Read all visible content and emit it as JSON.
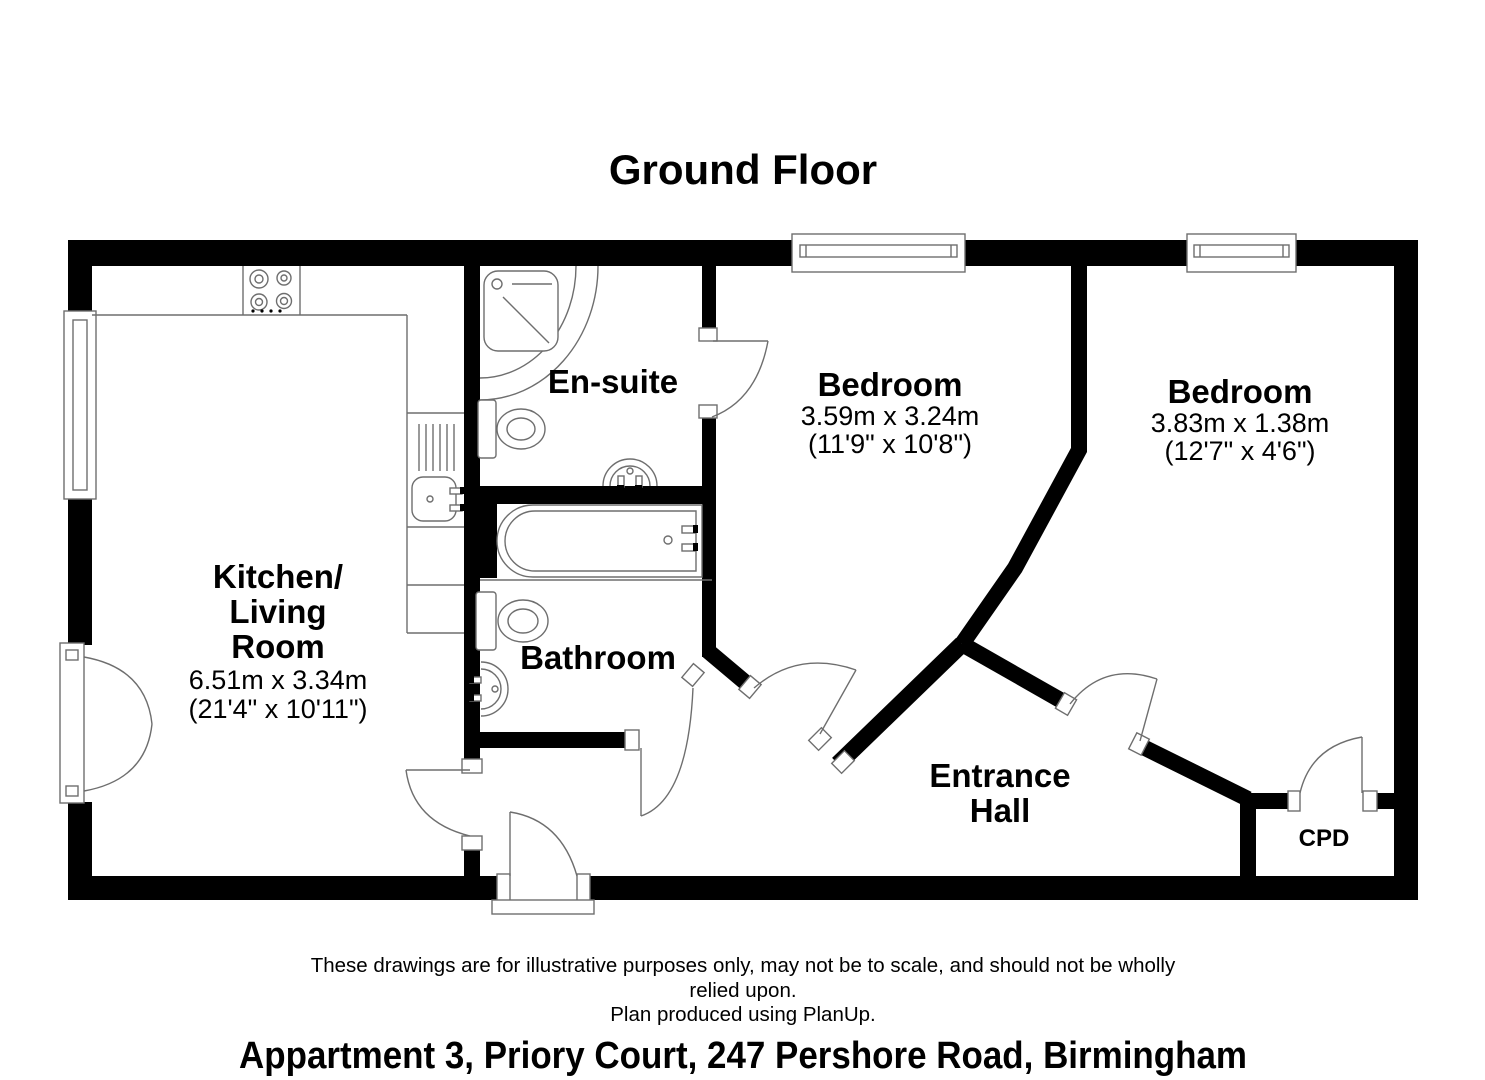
{
  "page": {
    "title": "Ground Floor",
    "address": "Appartment 3, Priory Court, 247 Pershore Road, Birmingham"
  },
  "disclaimer": {
    "line1": "These drawings are for illustrative purposes only, may not be to scale, and should not be wholly",
    "line2": "relied upon.",
    "line3": "Plan produced using PlanUp."
  },
  "rooms": {
    "kitchen": {
      "line1": "Kitchen/",
      "line2": "Living",
      "line3": "Room",
      "metric": "6.51m x 3.34m",
      "imperial": "(21'4\" x 10'11\")"
    },
    "ensuite": {
      "name": "En-suite"
    },
    "bathroom": {
      "name": "Bathroom"
    },
    "bedroom1": {
      "name": "Bedroom",
      "metric": "3.59m x 3.24m",
      "imperial": "(11'9\" x 10'8\")"
    },
    "bedroom2": {
      "name": "Bedroom",
      "metric": "3.83m x 1.38m",
      "imperial": "(12'7\" x 4'6\")"
    },
    "hall": {
      "line1": "Entrance",
      "line2": "Hall"
    },
    "cpd": {
      "name": "CPD"
    }
  },
  "colors": {
    "wall": "#000000",
    "fixture_line": "#6e6e6e",
    "background": "#ffffff",
    "text": "#000000"
  }
}
